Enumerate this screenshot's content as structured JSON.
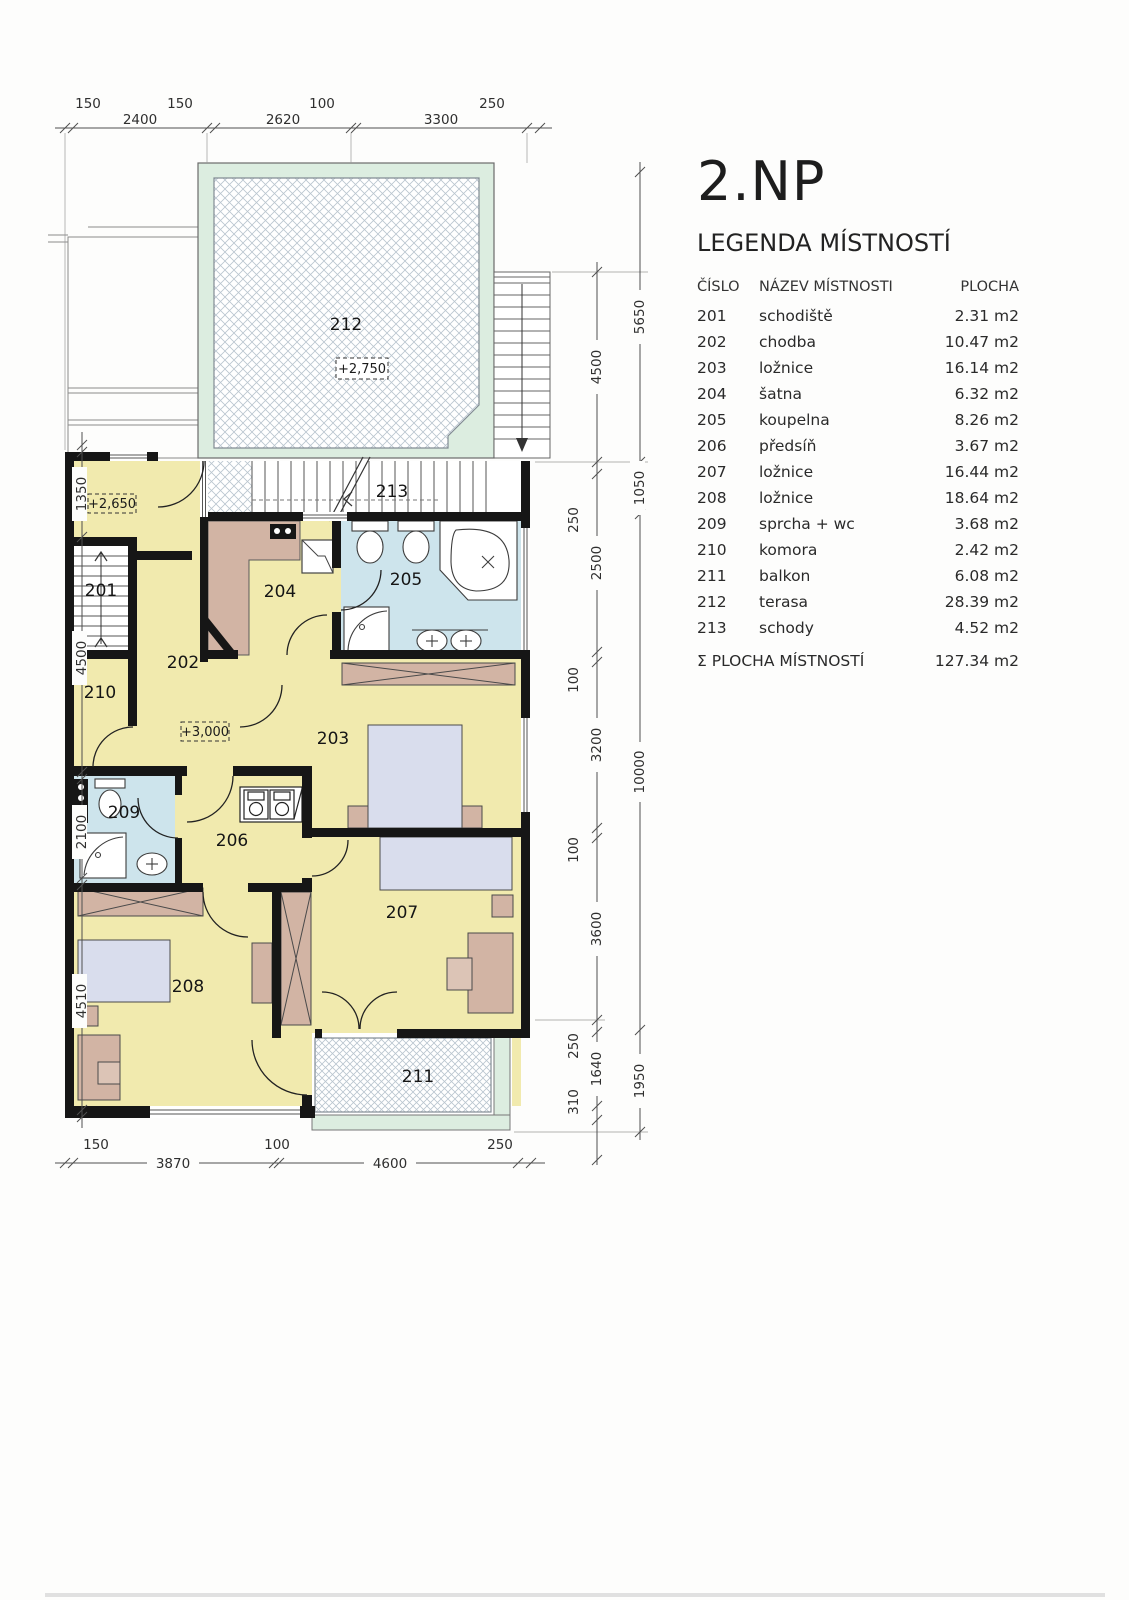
{
  "header": {
    "title": "2.NP"
  },
  "legend": {
    "heading": "LEGENDA MÍSTNOSTÍ",
    "columns": {
      "number": "ČÍSLO",
      "name": "NÁZEV MÍSTNOSTI",
      "area": "PLOCHA"
    },
    "rows": [
      {
        "number": "201",
        "name": "schodiště",
        "area": "2.31 m2"
      },
      {
        "number": "202",
        "name": "chodba",
        "area": "10.47 m2"
      },
      {
        "number": "203",
        "name": "ložnice",
        "area": "16.14 m2"
      },
      {
        "number": "204",
        "name": "šatna",
        "area": "6.32 m2"
      },
      {
        "number": "205",
        "name": "koupelna",
        "area": "8.26 m2"
      },
      {
        "number": "206",
        "name": "předsíň",
        "area": "3.67 m2"
      },
      {
        "number": "207",
        "name": "ložnice",
        "area": "16.44 m2"
      },
      {
        "number": "208",
        "name": "ložnice",
        "area": "18.64 m2"
      },
      {
        "number": "209",
        "name": "sprcha + wc",
        "area": "3.68 m2"
      },
      {
        "number": "210",
        "name": "komora",
        "area": "2.42 m2"
      },
      {
        "number": "211",
        "name": "balkon",
        "area": "6.08 m2"
      },
      {
        "number": "212",
        "name": "terasa",
        "area": "28.39 m2"
      },
      {
        "number": "213",
        "name": "schody",
        "area": "4.52 m2"
      }
    ],
    "total_label": "Σ PLOCHA MÍSTNOSTÍ",
    "total_area": "127.34 m2"
  },
  "plan": {
    "room_labels": {
      "201": "201",
      "202": "202",
      "203": "203",
      "204": "204",
      "205": "205",
      "206": "206",
      "207": "207",
      "208": "208",
      "209": "209",
      "210": "210",
      "211": "211",
      "212": "212",
      "213": "213"
    },
    "elevations": {
      "entry": "+2,650",
      "terrace": "+2,750",
      "hall": "+3,000"
    },
    "dims": {
      "top": [
        "150",
        "2400",
        "150",
        "2620",
        "100",
        "3300",
        "250"
      ],
      "bottom": [
        "150",
        "3870",
        "100",
        "4600",
        "250"
      ],
      "left": [
        "1350",
        "4500",
        "2100",
        "4510"
      ],
      "right_inner": [
        "4500",
        "250",
        "2500",
        "100",
        "3200",
        "100",
        "3600",
        "250",
        "1640",
        "310"
      ],
      "right_outer": [
        "5650",
        "1050",
        "10000",
        "1950"
      ]
    },
    "colors": {
      "wall": "#161616",
      "room_yellow": "#f1eaae",
      "bathroom_blue": "#cde4ec",
      "furniture_tan": "#d2b4a4",
      "terrace_mint": "#dcede0",
      "bed_lavender": "#d9dded",
      "hatch_line": "#b9c5cf"
    }
  }
}
